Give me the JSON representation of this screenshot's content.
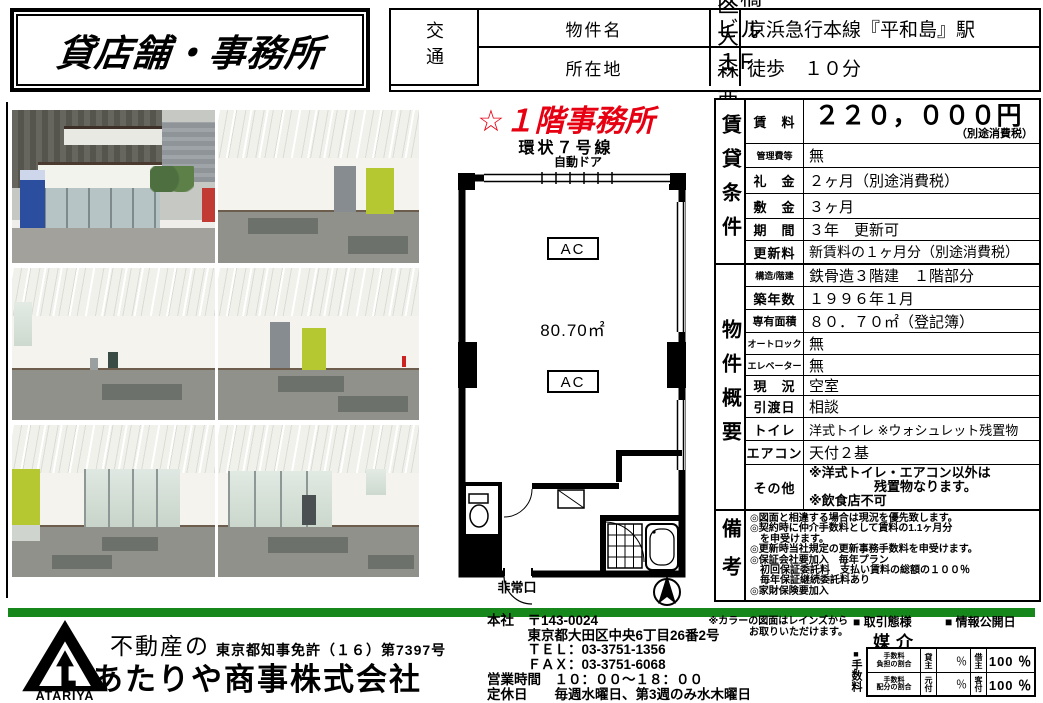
{
  "title_box": {
    "title": "貸店舗・事務所"
  },
  "header": {
    "property_label": "物件名",
    "property_value": "大橋ビル　１F",
    "address_label": "所在地",
    "address_value": "大田区大森西１-６-６",
    "transport_label": "交通",
    "station": "京浜急行本線『平和島』駅",
    "walk": "徒歩　１０分"
  },
  "plan": {
    "headline": "☆１階事務所",
    "road": "環状７号線",
    "auto_door": "自動ドア",
    "ac": "AC",
    "area": "80.70㎡",
    "exit": "非常口"
  },
  "rent": {
    "section": "賃貸条件",
    "rows": [
      {
        "label": "賃　料",
        "value": "２２０，０００円",
        "sub": "（別途消費税）"
      },
      {
        "label": "管理費等",
        "value": "無"
      },
      {
        "label": "礼　金",
        "value": "２ヶ月（別途消費税）"
      },
      {
        "label": "敷　金",
        "value": "３ヶ月"
      },
      {
        "label": "期　間",
        "value": "３年　更新可"
      },
      {
        "label": "更新料",
        "value": "新賃料の１ヶ月分（別途消費税）"
      }
    ]
  },
  "overview": {
    "section": "物件概要",
    "rows": [
      {
        "label": "構造/階建",
        "value": "鉄骨造３階建　１階部分"
      },
      {
        "label": "築年数",
        "value": "１９９６年１月"
      },
      {
        "label": "専有面積",
        "value": "８０．７０㎡（登記簿）"
      },
      {
        "label": "オートロック",
        "value": "無"
      },
      {
        "label": "エレベーター",
        "value": "無"
      },
      {
        "label": "現　況",
        "value": "空室"
      },
      {
        "label": "引渡日",
        "value": "相談"
      },
      {
        "label": "トイレ",
        "value": "洋式トイレ ※ウォシュレット残置物"
      },
      {
        "label": "エアコン",
        "value": "天付２基"
      }
    ],
    "other_label": "その他",
    "other_value": "※洋式トイレ・エアコン以外は\n　　　　　残置物なります。\n※飲食店不可"
  },
  "notes": {
    "section": "備考",
    "text": "◎図面と相違する場合は現況を優先致します。\n◎契約時に仲介手数料として賃料の1.1ヶ月分\n　を申受けます。\n◎更新時当社規定の更新事務手数料を申受けます。\n◎保証会社要加入　毎年プラン\n　初回保証委託料　支払い賃料の総額の１００％\n　毎年保証継続委託料あり\n◎家財保険要加入"
  },
  "footer": {
    "company_prefix": "不動産の",
    "company_name": "あたりや商事株式会社",
    "logo_text": "ATARIYA",
    "license": "東京都知事免許（１６）第7397号",
    "hq": "本社　〒143-0024\n　　　東京都大田区中央6丁目26番2号\n　　　ＴＥＬ：03-3751-1356\n　　　ＦＡＸ：03-3751-6068\n営業時間　１０：００～１８：００\n定休日　　毎週水曜日、第3週のみ水木曜日",
    "color_note": "※カラーの図面はレインズから\nお取りいただけます。",
    "deal_label": "■ 取引態様",
    "deal_value": "媒介",
    "publish_label": "■ 情報公開日",
    "fee_mark": "■",
    "fee_label": "手数料",
    "fee": {
      "row1": {
        "name": "手数料\n負担の割合",
        "head_l": "貸主",
        "val_l": "％",
        "head_r": "借主",
        "val_r": "100 ％"
      },
      "row2": {
        "name": "手数料\n配分の割合",
        "head_l": "元付",
        "val_l": "％",
        "head_r": "客付",
        "val_r": "100 ％"
      }
    }
  },
  "colors": {
    "accent_red": "#e60012",
    "bar_green": "#15871b",
    "panel_green": "#b5c832"
  }
}
